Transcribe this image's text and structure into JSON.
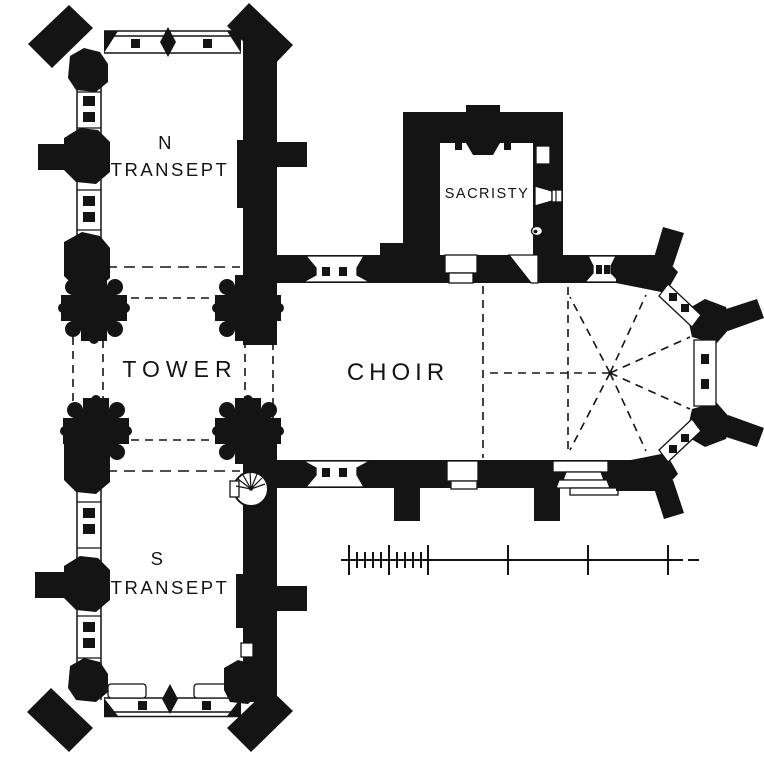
{
  "plan": {
    "title": "church-floor-plan",
    "labels": {
      "n_transept_line1": "N",
      "n_transept_line2": "TRANSEPT",
      "tower": "TOWER",
      "choir": "CHOIR",
      "sacristy": "SACRISTY",
      "s_transept_line1": "S",
      "s_transept_line2": "TRANSEPT"
    },
    "colors": {
      "ink": "#141414",
      "paper": "#ffffff"
    }
  }
}
